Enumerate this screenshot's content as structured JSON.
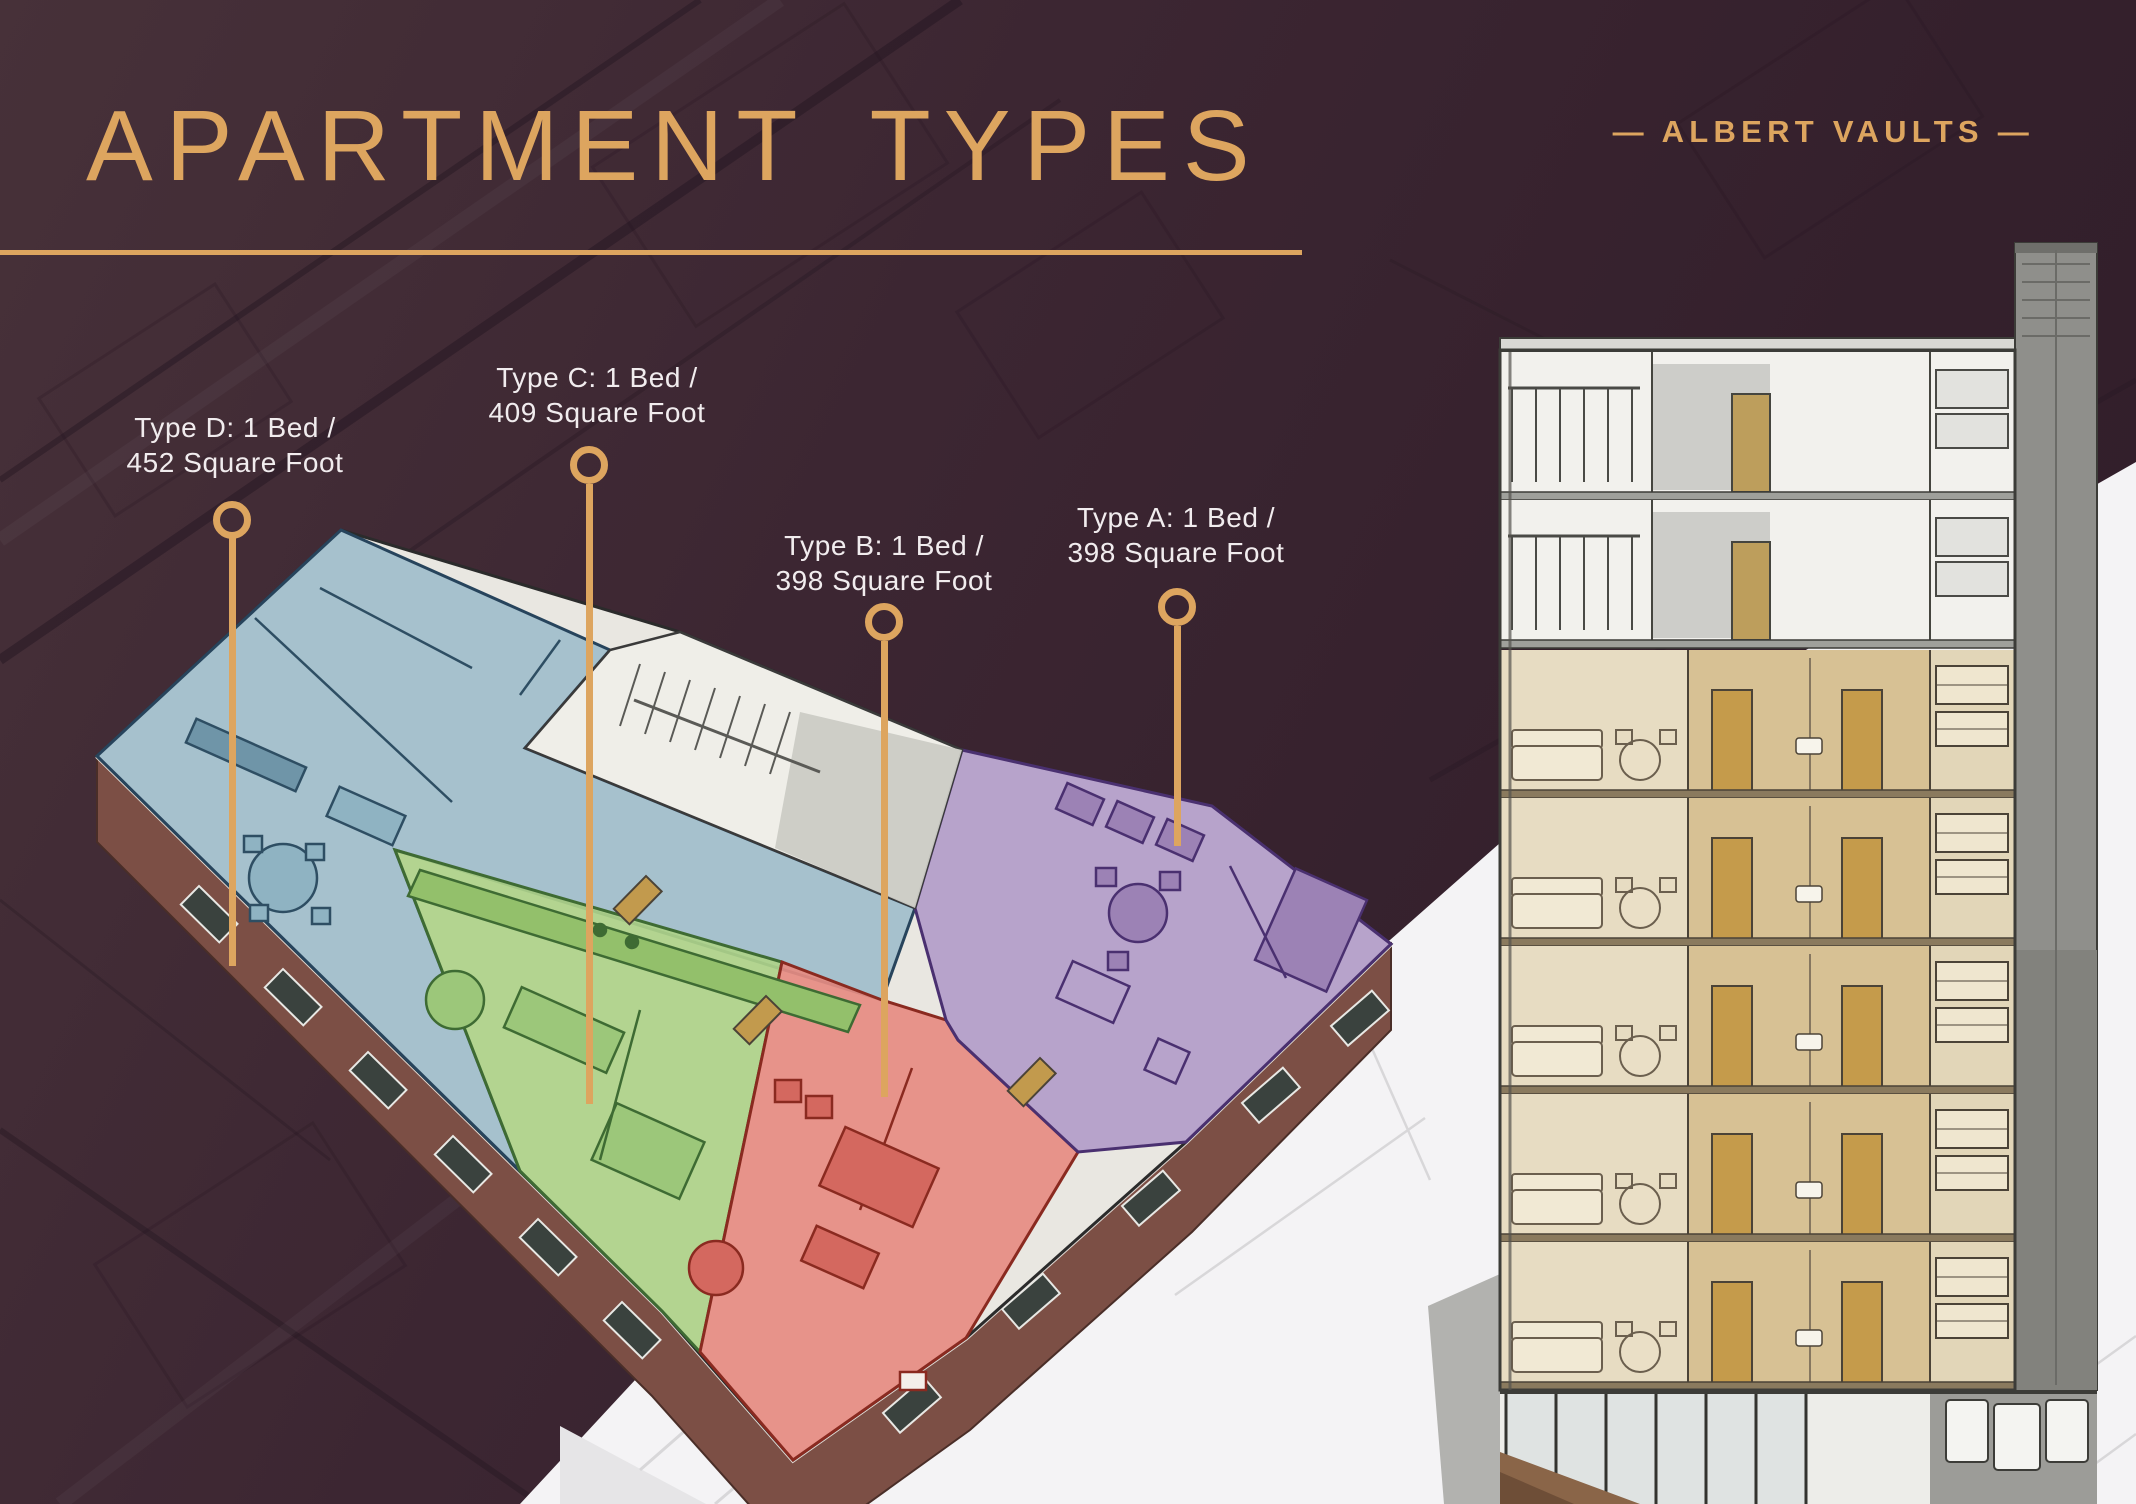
{
  "slide": {
    "title": "APARTMENT TYPES",
    "brand": "— ALBERT VAULTS —"
  },
  "apartment_types": [
    {
      "type": "Type A",
      "label_line1": "Type A: 1 Bed /",
      "label_line2": "398 Square Foot",
      "color": "#B29DC9"
    },
    {
      "type": "Type B",
      "label_line1": "Type B: 1 Bed /",
      "label_line2": "398 Square Foot",
      "color": "#E68C82"
    },
    {
      "type": "Type C",
      "label_line1": "Type C: 1 Bed /",
      "label_line2": "409 Square Foot",
      "color": "#AED389"
    },
    {
      "type": "Type D",
      "label_line1": "Type D: 1 Bed /",
      "label_line2": "452 Square Foot",
      "color": "#9FBECB"
    }
  ],
  "palette": {
    "background_maroon": "#3B2531",
    "accent_gold": "#DDA55F",
    "label_text": "#F1ECEE",
    "type_a_purple": "#B29DC9",
    "type_b_red": "#E68C82",
    "type_c_green": "#AED389",
    "type_d_blue": "#9FBECB",
    "brick": "#7C4F45",
    "section_highlight_tan": "#D7C194",
    "backdrop_white": "#F4F3F5"
  }
}
